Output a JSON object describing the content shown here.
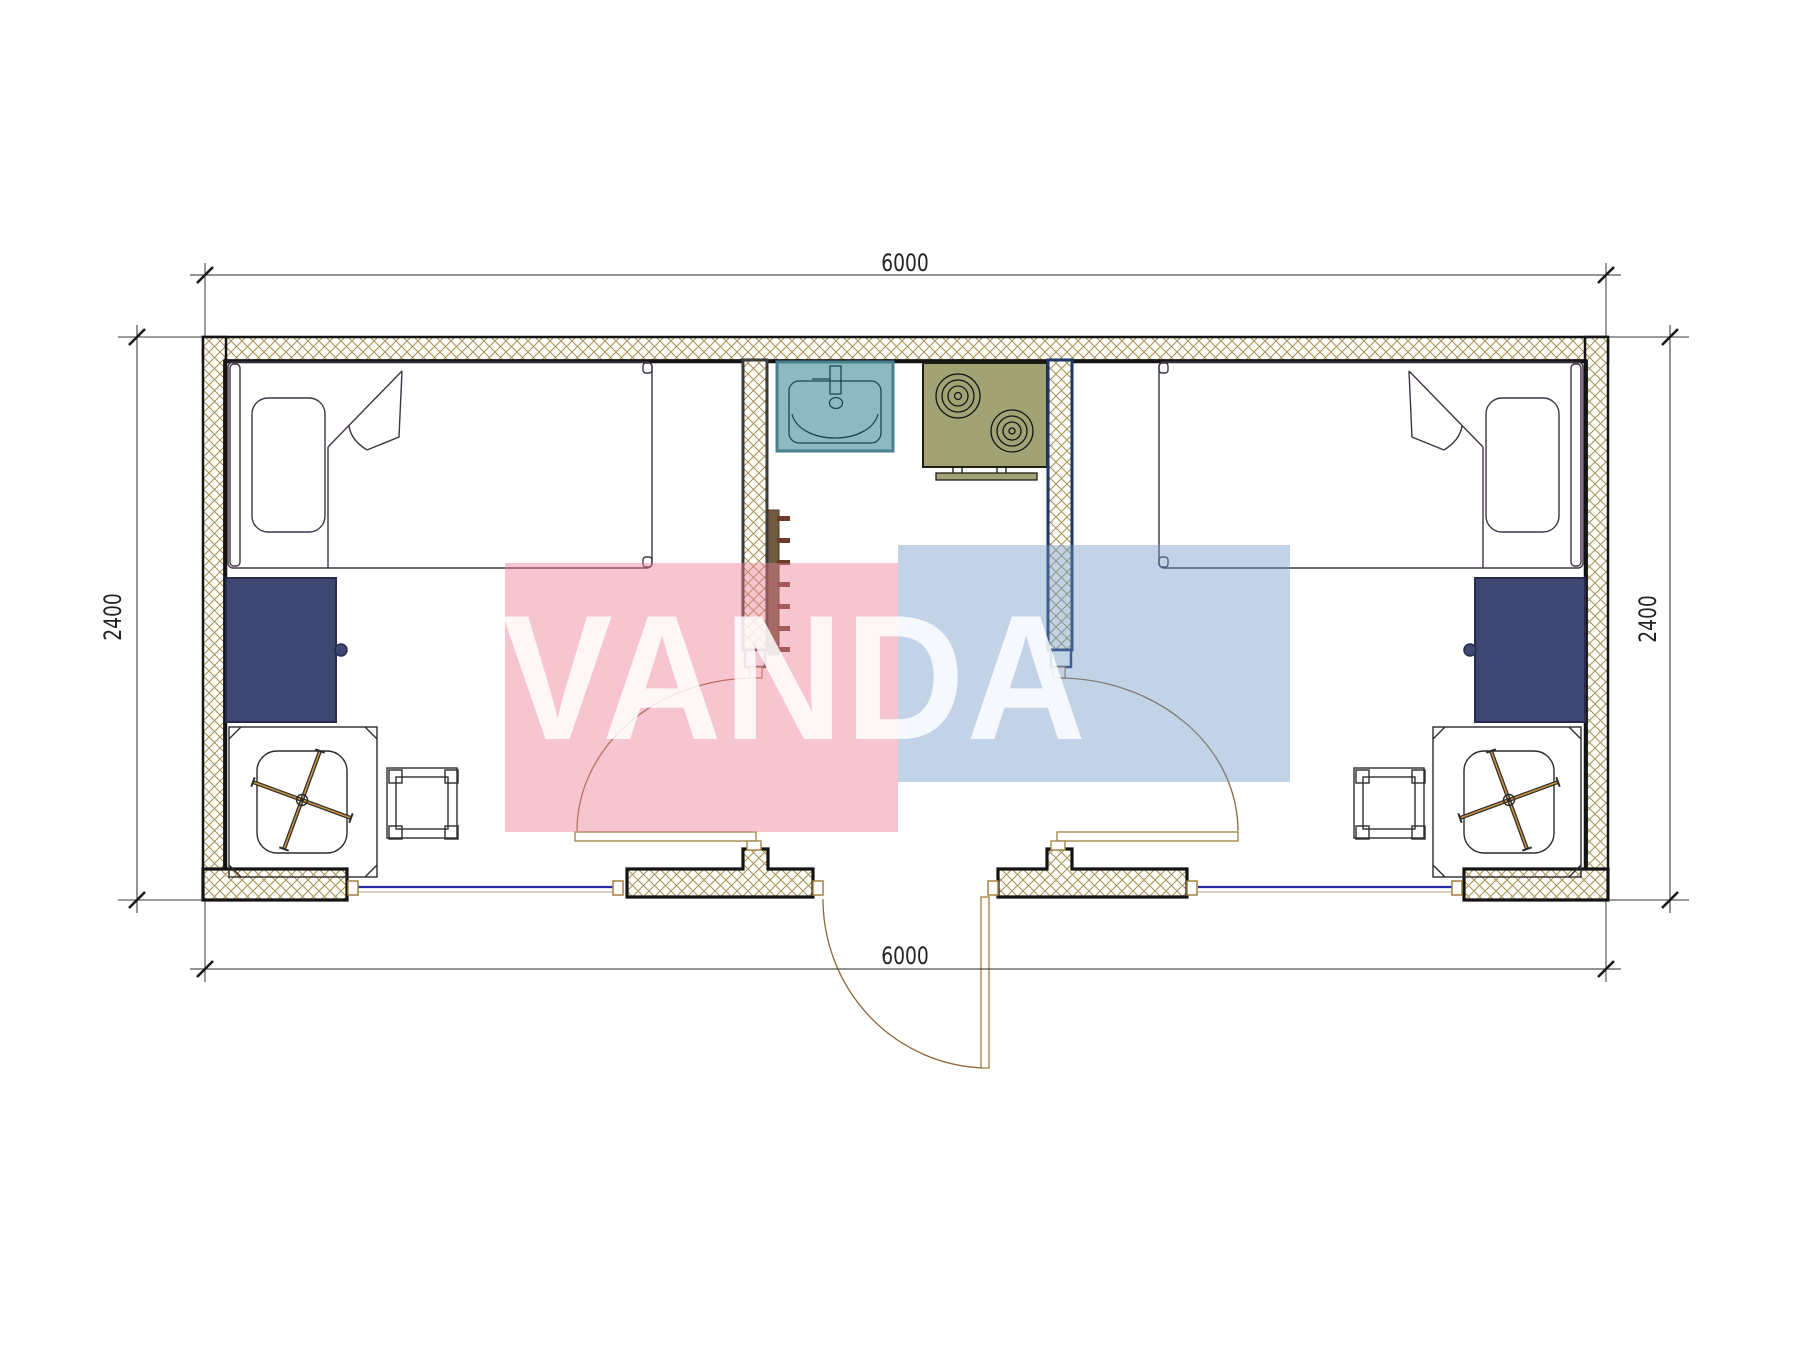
{
  "drawing": {
    "type": "architectural-floor-plan",
    "plan_width_mm": "6000",
    "plan_depth_mm": "2400"
  },
  "dimensions": {
    "top": "6000",
    "bottom": "6000",
    "left": "2400",
    "right": "2400"
  },
  "watermark": {
    "text": "VANDA",
    "pink_block_color": "rgba(235,127,149,0.45)",
    "blue_block_color": "rgba(110,150,200,0.42)",
    "text_color": "rgba(255,255,255,0.84)"
  },
  "colors": {
    "wall_outline": "#141414",
    "wall_hatch_line": "#a4925c",
    "wall_fill": "#fffef8",
    "partition_left_outline": "#3a3a3a",
    "partition_right_outline": "#1e3666",
    "bed": "#9c8798",
    "pillow": "#a18e9e",
    "desk": "#3e4672",
    "chair": "#c8923e",
    "stool": "#999999",
    "stool_leg": "#858585",
    "sink": "#8fb9c1",
    "sink_border": "#48808f",
    "stove": "#a2a375",
    "heater_bar": "#6f5c3f",
    "heater_rung": "#6b3c2b",
    "window_line": "#2b2ba8",
    "door_line": "#8a6a3a",
    "dimension_text": "#222222"
  },
  "furniture": [
    "bed-left",
    "pillow-left",
    "desk-left",
    "office-chair-left",
    "stool-left",
    "sink",
    "stove",
    "towel-radiator",
    "bed-right",
    "pillow-right",
    "desk-right",
    "office-chair-right",
    "stool-right"
  ]
}
